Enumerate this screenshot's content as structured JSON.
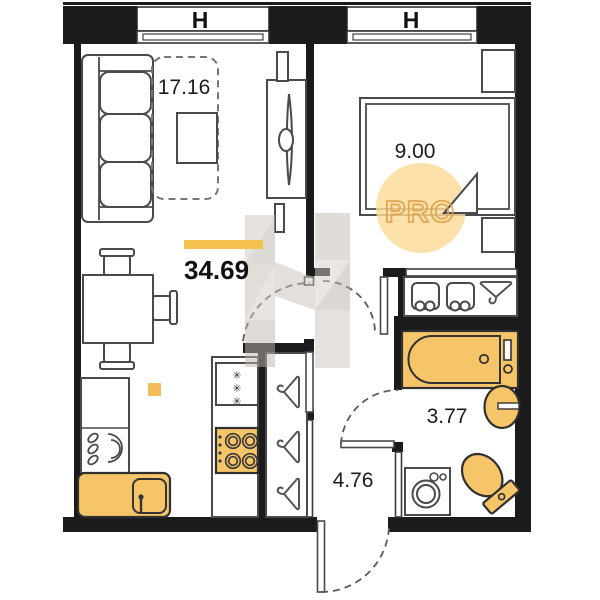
{
  "plan": {
    "window_labels": {
      "left": "H",
      "right": "H"
    },
    "total_area": "34.69",
    "rooms": {
      "living": {
        "area": "17.16"
      },
      "bedroom": {
        "area": "9.00"
      },
      "bathroom": {
        "area": "3.77"
      },
      "hall": {
        "area": "4.76"
      }
    },
    "watermark": {
      "text": "PRO"
    },
    "icons": {
      "snowflake": "✳"
    },
    "colors": {
      "wall": "#1b1b1b",
      "line": "#4a4a4a",
      "orange": "#f7c569",
      "accent-bar": "#f5c14e",
      "wm-circle": "#fbdc97",
      "wm-orange": "#dd9f45",
      "wm-gray": "#c7bfb6"
    }
  }
}
